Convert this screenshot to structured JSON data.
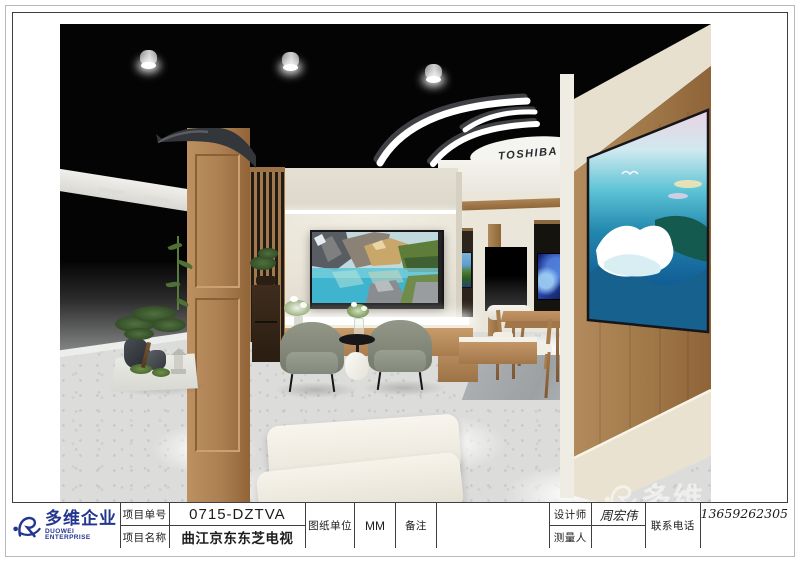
{
  "titleblock": {
    "company_cn": "多维企业",
    "company_en": "DUOWEI ENTERPRISE",
    "project_no_label": "项目单号",
    "project_no": "0715-DZTVA",
    "project_name_label": "项目名称",
    "project_name": "曲江京东东芝电视",
    "unit_label": "图纸单位",
    "unit": "MM",
    "remark_label": "备注",
    "remark": "",
    "designer_label": "设计师",
    "designer": "周宏伟",
    "surveyor_label": "测量人",
    "surveyor": "",
    "phone_label": "联系电话",
    "phone": "13659262305"
  },
  "rendering": {
    "brand_disc_text": "TOSHIBA",
    "watermark_text": "多维"
  },
  "colors": {
    "logo_blue": "#23368f",
    "ceiling_black": "#040404",
    "wall_cream": "#eae5da",
    "wood": "#ab7f51",
    "floor_gray": "#dcdcda",
    "armchair_gray": "#878b7f"
  }
}
